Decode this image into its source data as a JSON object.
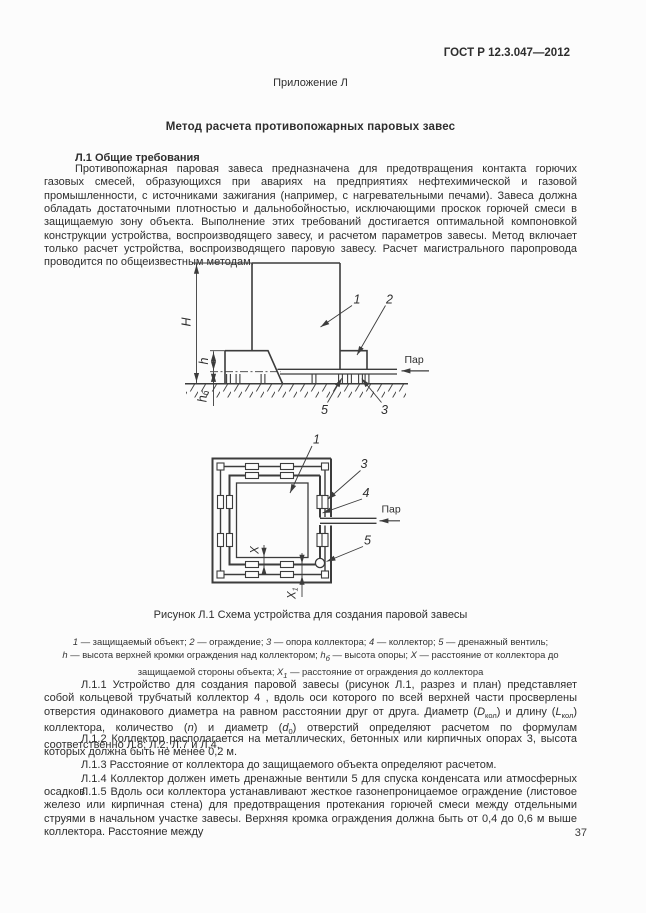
{
  "page": {
    "header": "ГОСТ Р 12.3.047—2012",
    "annex": "Приложение  Л",
    "title": "Метод расчета противопожарных паровых завес",
    "section_heading": "Л.1 Общие требования",
    "page_number": "37"
  },
  "paragraphs": {
    "intro": "Противопожарная паровая завеса предназначена для предотвращения контакта горючих газовых смесей, образующихся при авариях на предприятиях нефтехимической и газовой промышленности, с источниками зажигания (например, с нагревательными печами). Завеса должна обладать достаточными плотностью и дальнобойностью, исключающими проскок горючей смеси в защищаемую зону объекта. Выполнение этих требований достигается оптимальной компоновкой конструкции устройства, воспроизводящего завесу, и расчетом параметров завесы. Метод включает только расчет устройства, воспроизводящего паровую завесу. Расчет магистрального паропровода проводится по общеизвестным методам.",
    "p11": {
      "a": "Л.1.1 Устройство для создания паровой завесы (рисунок Л.1, разрез и план) представляет собой кольцевой трубчатый коллектор 4 , вдоль оси которого по всей верхней части просверлены отверстия одинакового диаметра на равном расстоянии друг от друга. Диаметр (",
      "sym_d": "D",
      "sym_d_sub": "кол",
      "b": ") и длину (",
      "sym_l": "L",
      "sym_l_sub": "кол",
      "c": ") коллектора, количество (",
      "sym_n": "n",
      "d": ")  и диаметр (",
      "sym_d0": "d",
      "sym_d0_sub": "0",
      "e": ") отверстий определяют расчетом по формулам соответственно Л.8; Л.2; Л.7 и Л.4."
    },
    "p12": "Л.1.2 Коллектор располагается на металлических, бетонных или кирпичных опорах 3, высота которых должна быть не менее 0,2 м.",
    "p13": "Л.1.3 Расстояние от коллектора до защищаемого объекта определяют расчетом.",
    "p14": "Л.1.4 Коллектор должен иметь дренажные вентили  5 для спуска конденсата или атмосферных осадков.",
    "p15": "Л.1.5 Вдоль оси коллектора устанавливают жесткое газонепроницаемое ограждение (листовое железо или кирпичная стена) для предотвращения протекания горючей смеси между отдельными струями в начальном участке завесы. Верхняя кромка ограждения должна быть от 0,4 до 0,6 м выше коллектора. Расстояние между"
  },
  "figure": {
    "caption": "Рисунок  Л.1 Схема устройства для создания паровой завесы",
    "legend_items": [
      {
        "sym": "1",
        "text": " — защищаемый объект; "
      },
      {
        "sym": "2",
        "text": " — ограждение; "
      },
      {
        "sym": "3",
        "text": " — опора коллектора; "
      },
      {
        "sym": "4",
        "text": " — коллектор; "
      },
      {
        "sym": "5",
        "text": " — дренажный вентиль;"
      },
      {
        "sym": "h",
        "text": " — высота верхней кромки ограждения над коллектором; "
      },
      {
        "sym": "h",
        "sub": "б",
        "text": " — высота опоры; "
      },
      {
        "sym": "X",
        "text": " — расстояние от коллектора до защищаемой стороны объекта; "
      },
      {
        "sym": "X",
        "sub": "1",
        "text": " — расстояние от ограждения до коллектора"
      }
    ]
  },
  "fig_elevation": {
    "labels": {
      "H": "H",
      "h": "h",
      "h_support": "h",
      "h_support_sub": "б",
      "callout_1": "1",
      "callout_2": "2",
      "callout_3": "3",
      "callout_5": "5",
      "steam": "Пар"
    }
  },
  "fig_plan": {
    "labels": {
      "callout_1": "1",
      "callout_3": "3",
      "callout_4": "4",
      "callout_5": "5",
      "steam": "Пар",
      "X": "X",
      "X1": "X",
      "X1_sub": "1"
    }
  },
  "colors": {
    "ink": "#2e2e2e",
    "line": "#3c3c3c",
    "paper": "#fcfcfc"
  }
}
